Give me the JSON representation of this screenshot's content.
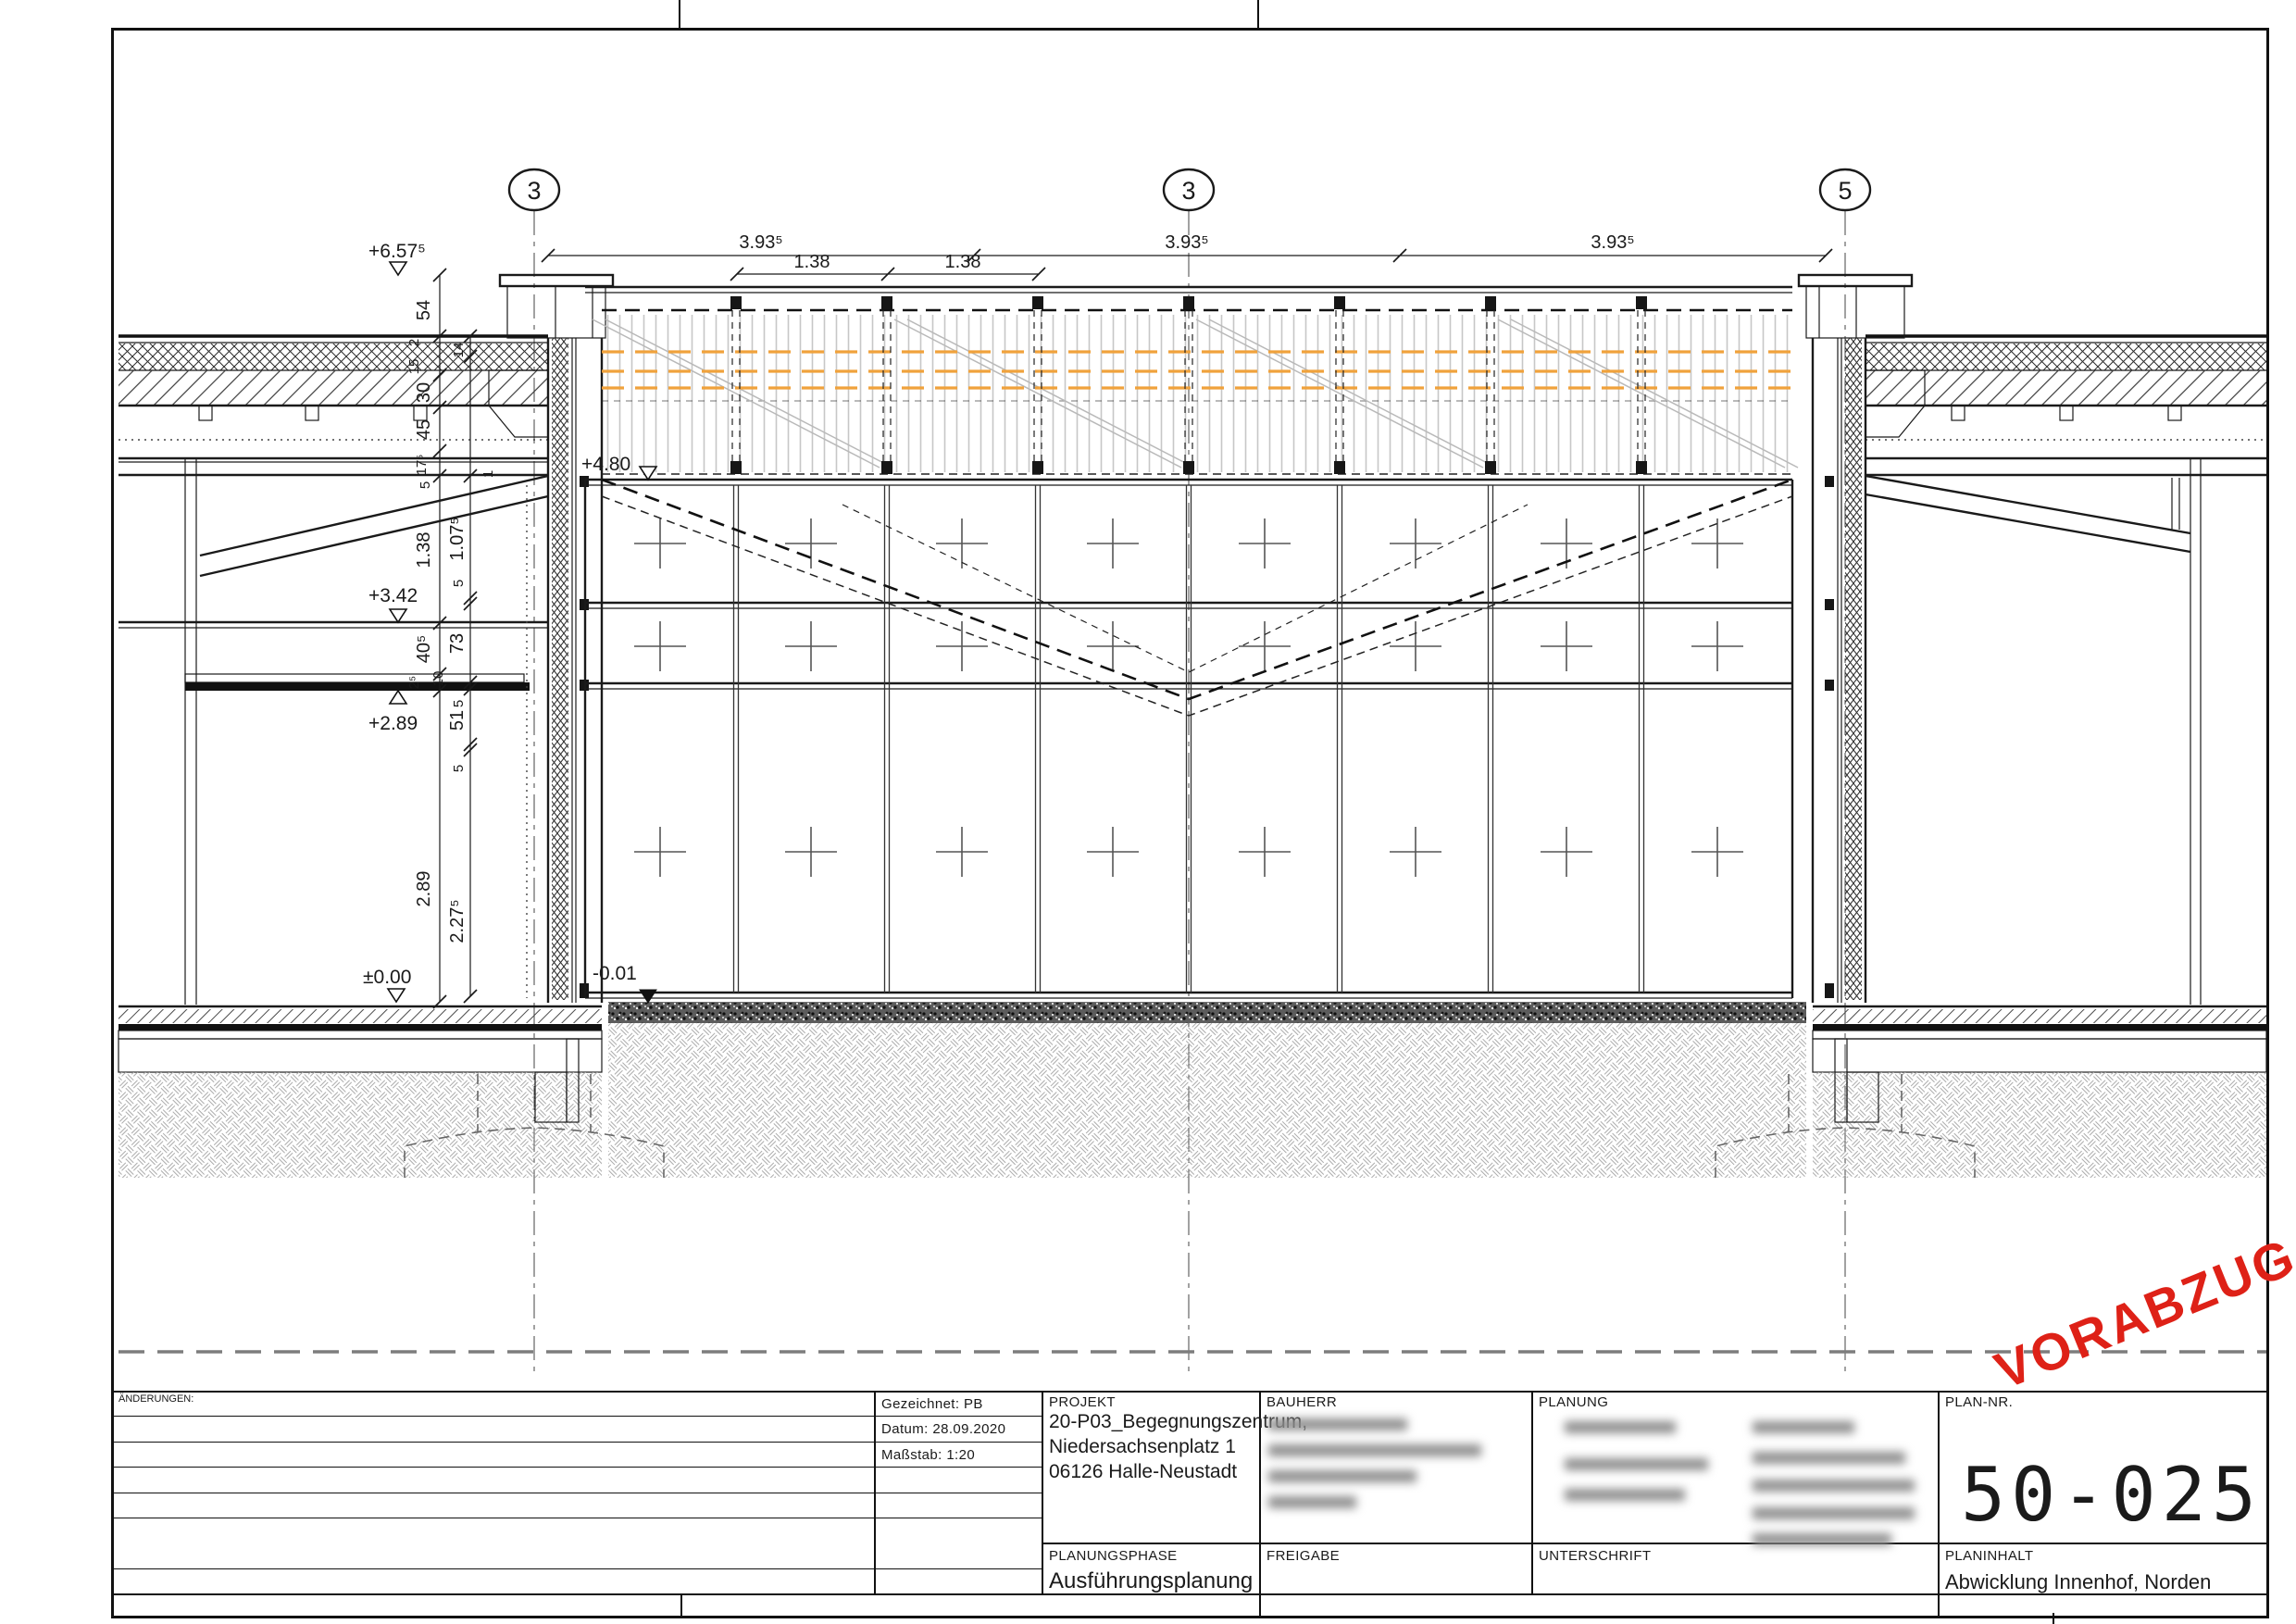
{
  "page": {
    "stamp": "VORABZUG",
    "stamp_color": "#de2117"
  },
  "titleblock": {
    "aenderungen_label": "ÄNDERUNGEN:",
    "meta": {
      "gezeichnet_label": "Gezeichnet:",
      "gezeichnet_value": "PB",
      "datum_label": "Datum:",
      "datum_value": "28.09.2020",
      "massstab_label": "Maßstab:",
      "massstab_value": "1:20"
    },
    "projekt": {
      "label": "PROJEKT",
      "line1": "20-P03_Begegnungszentrum,",
      "line2": "Niedersachsenplatz 1",
      "line3": "06126 Halle-Neustadt"
    },
    "bauherr": {
      "label": "BAUHERR"
    },
    "planung": {
      "label": "PLANUNG"
    },
    "plannr": {
      "label": "PLAN-NR.",
      "value": "50-025"
    },
    "planungsphase": {
      "label": "PLANUNGSPHASE",
      "value": "Ausführungsplanung"
    },
    "freigabe": {
      "label": "FREIGABE"
    },
    "unterschrift": {
      "label": "UNTERSCHRIFT"
    },
    "planinhalt": {
      "label": "PLANINHALT",
      "value": "Abwicklung Innenhof, Norden"
    }
  },
  "drawing": {
    "grid_bubbles": {
      "b1": "3",
      "b2": "3",
      "b3": "5"
    },
    "dims_top": {
      "d1": "3.93⁵",
      "d2": "3.93⁵",
      "d3": "3.93⁵"
    },
    "dims_sub": {
      "d1": "1.38",
      "d2": "1.38"
    },
    "levels": {
      "l1": "+6.57⁵",
      "l2": "+4.80",
      "l3": "+3.42",
      "l4": "+2.89",
      "l5": "±0.00",
      "l6": "-0.01"
    },
    "chain_outer": {
      "v54": "54",
      "v2": "2",
      "v15": "15",
      "v30": "30",
      "v45": "45",
      "v175": "17⁵",
      "v5": "5",
      "v138": "1.38",
      "v405": "40⁵",
      "v25": "2⁵",
      "v289": "2.89"
    },
    "chain_inner": {
      "v14": "14",
      "v1": "1",
      "v1075": "1.07⁵",
      "v5a": "5",
      "v73": "73",
      "v5b": "5",
      "v51": "51",
      "v5c": "5",
      "v10": "10",
      "v2275": "2.27⁵"
    }
  }
}
